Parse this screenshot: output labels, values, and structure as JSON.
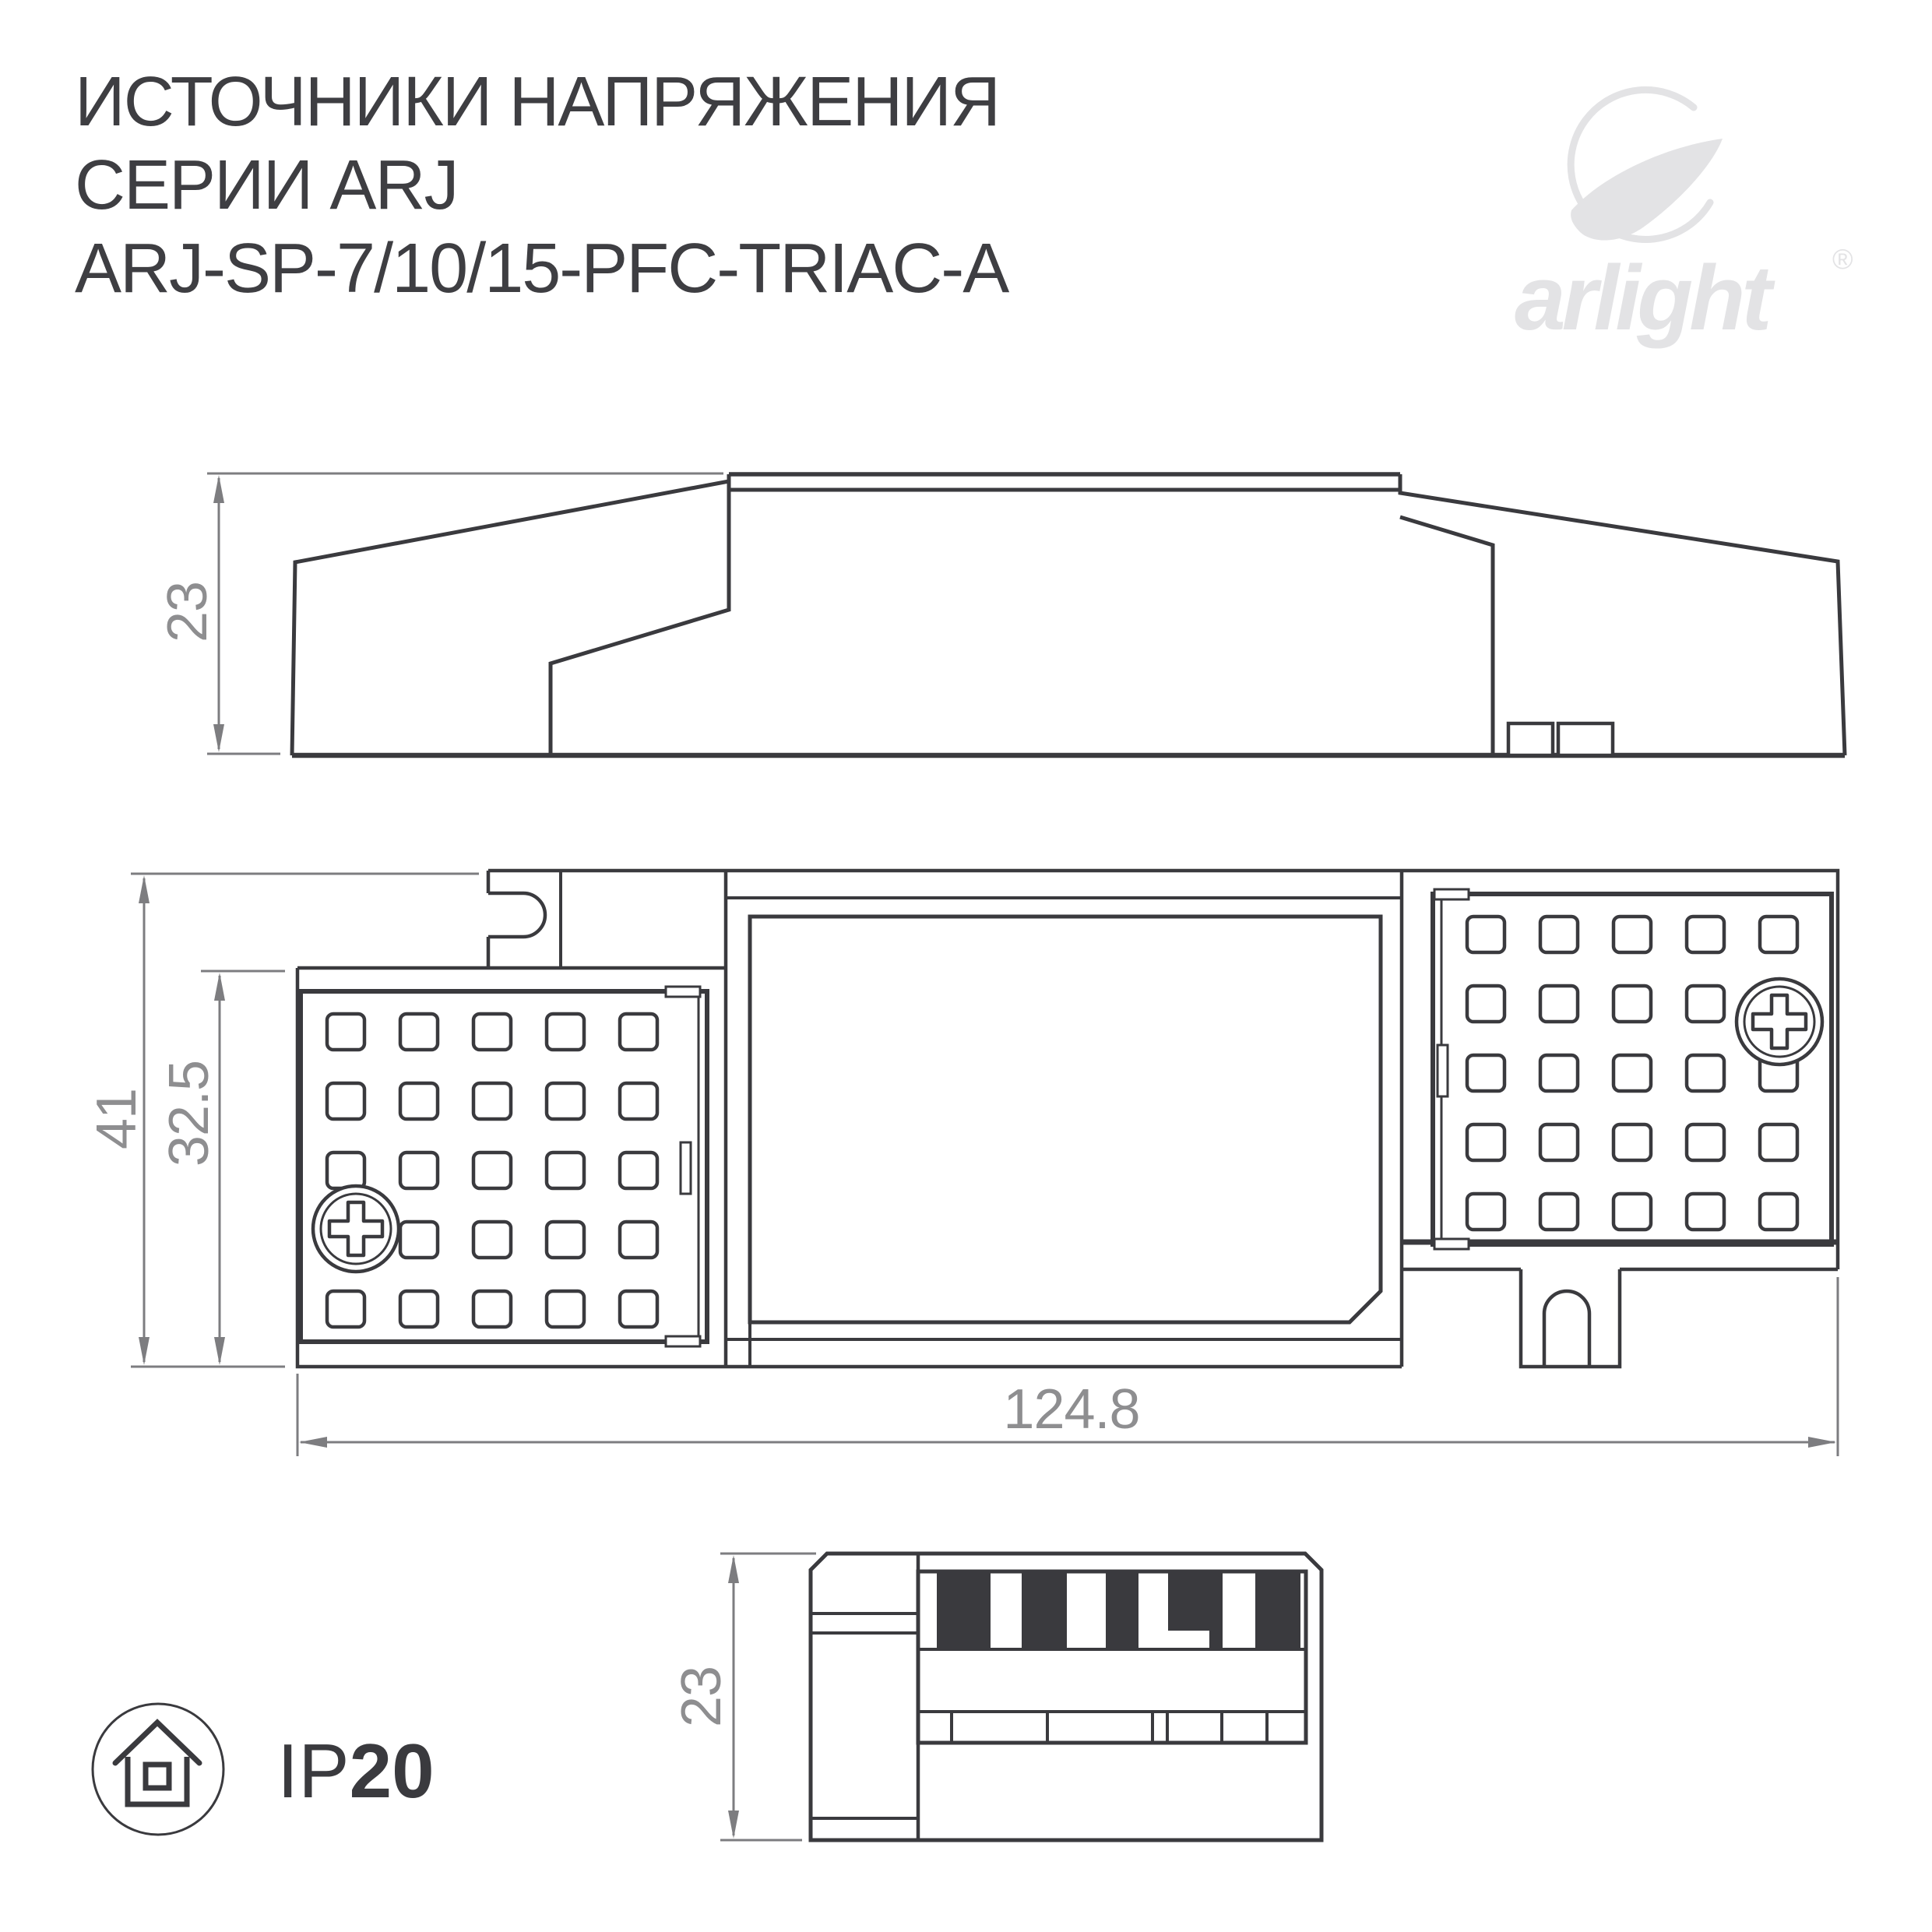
{
  "header": {
    "title_line1": "ИСТОЧНИКИ НАПРЯЖЕНИЯ",
    "title_line2": "СЕРИИ ARJ",
    "title_line3": "ARJ-SP-7/10/15-PFC-TRIAC-A"
  },
  "logo": {
    "text": "arlight",
    "registered": "®"
  },
  "views": {
    "side_view": {
      "dim_height": "23"
    },
    "top_view": {
      "dim_overall_width": "41",
      "dim_panel_width": "32.5",
      "dim_length": "124.8"
    },
    "end_view": {
      "dim_height": "23"
    }
  },
  "badge": {
    "ip_prefix": "IP",
    "ip_value": "20"
  },
  "colors": {
    "drawing_line": "#3a3a3e",
    "dimension_line": "#7d7d80",
    "dimension_text": "#8e8e90",
    "title_text": "#3e3e42",
    "logo_gray": "#e3e3e5"
  }
}
